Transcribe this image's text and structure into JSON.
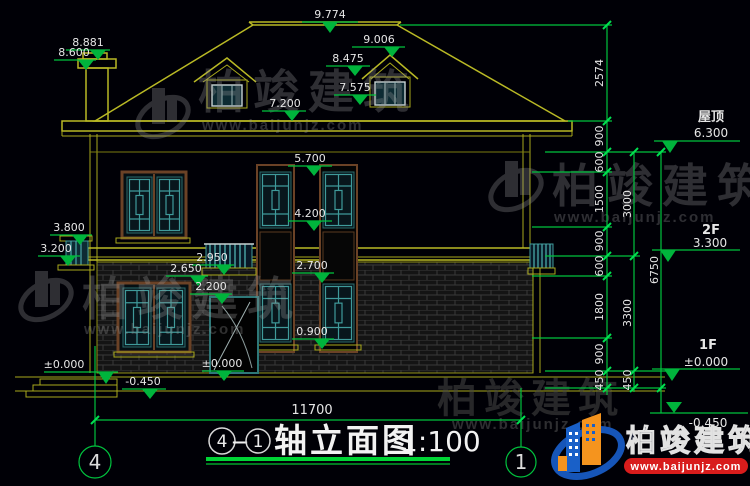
{
  "watermark": {
    "brand": "柏竣建筑",
    "url": "www.baijunjz.com"
  },
  "logo": {
    "brand": "柏竣建筑",
    "url": "www.baijunjz.com"
  },
  "title": {
    "axis_start": "4",
    "dash": "—",
    "axis_end": "1",
    "text": "轴立面图",
    "scale": "1:100"
  },
  "axis_bubbles": {
    "left": "4",
    "right": "1"
  },
  "overall_dim": "11700",
  "levels": [
    {
      "label": "屋顶",
      "value": "6.300"
    },
    {
      "label": "2F",
      "value": "3.300"
    },
    {
      "label": "1F",
      "value": "±0.000"
    },
    {
      "label": "",
      "value": "-0.450"
    }
  ],
  "elevations": {
    "ridge": "9.774",
    "dormer_top": "9.006",
    "dormer_mid": "8.475",
    "dormer_base": "7.575",
    "eave_top": "7.200",
    "chimney_top": "8.881",
    "chimney_cap": "8.600",
    "win2f_top": "5.700",
    "win2f_sill": "4.200",
    "left_win_top": "3.800",
    "left_win_sill": "3.200",
    "rail_top": "2.950",
    "rail_base": "2.650",
    "door_top": "2.200",
    "win1f_top": "2.700",
    "win1f_sill": "0.900",
    "ground_left": "±0.000",
    "ground_mid": "-0.450",
    "door_base": "±0.000"
  },
  "dim_chain_inner": [
    "2574",
    "900",
    "600",
    "1500",
    "900",
    "600",
    "1800",
    "900",
    "450"
  ],
  "dim_chain_story": [
    "3000",
    "3300",
    "450"
  ],
  "dim_total_right": "6750"
}
